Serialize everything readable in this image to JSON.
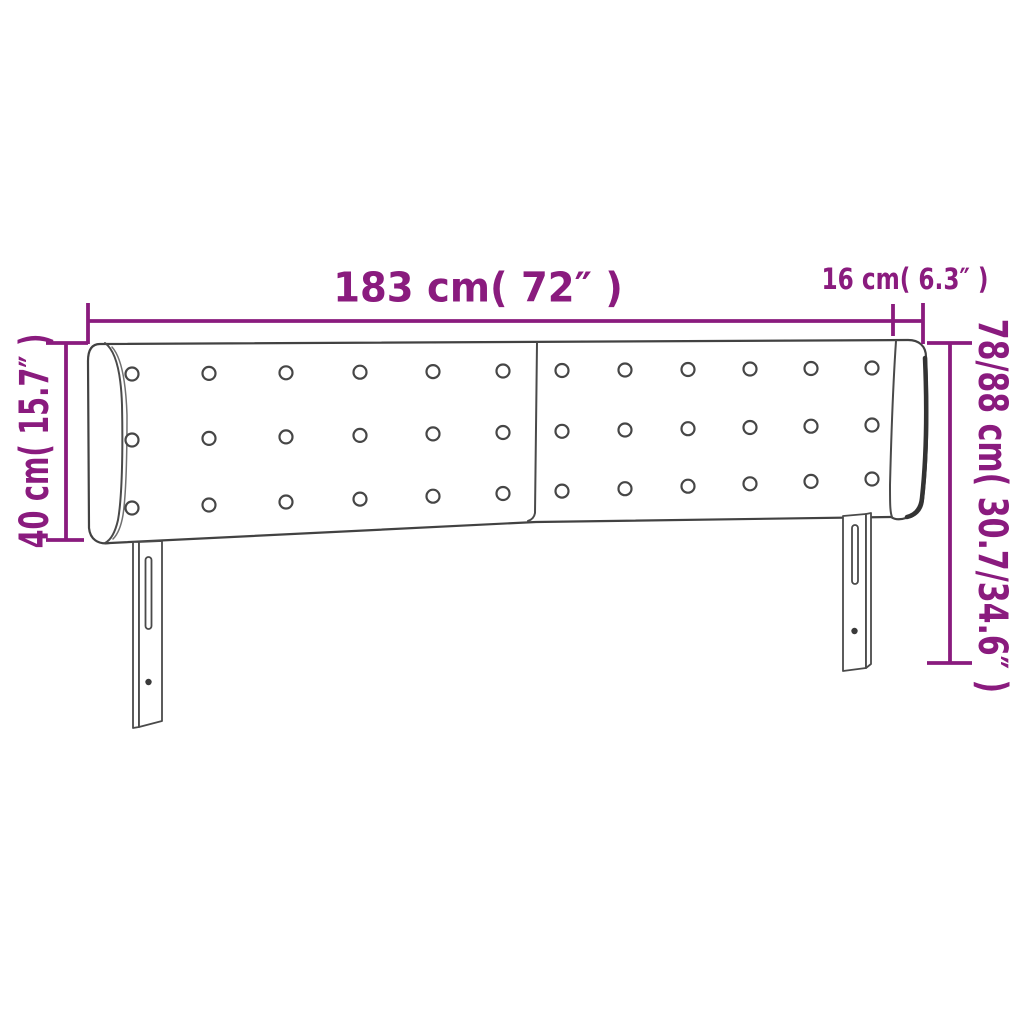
{
  "diagram": {
    "title": "Headboard with ears - dimension diagram",
    "style": {
      "dimension_color": "#8A1B7E",
      "outline_color": "#424242",
      "background_color": "#ffffff"
    },
    "measurements": [
      {
        "id": "width",
        "label": "183 cm( 72″ )",
        "cm": "183",
        "inches": "72"
      },
      {
        "id": "ear-depth",
        "label": "16 cm( 6.3″ )",
        "cm": "16",
        "inches": "6.3"
      },
      {
        "id": "panel-height",
        "label": "40 cm( 15.7″ )",
        "cm": "40",
        "inches": "15.7"
      },
      {
        "id": "total-height",
        "label": "78/88 cm( 30.7/34.6″ )",
        "cm": "78/88",
        "inches": "30.7/34.6"
      }
    ],
    "buttons": {
      "rows": 3,
      "columns_per_panel": 6,
      "panels": 2
    }
  }
}
